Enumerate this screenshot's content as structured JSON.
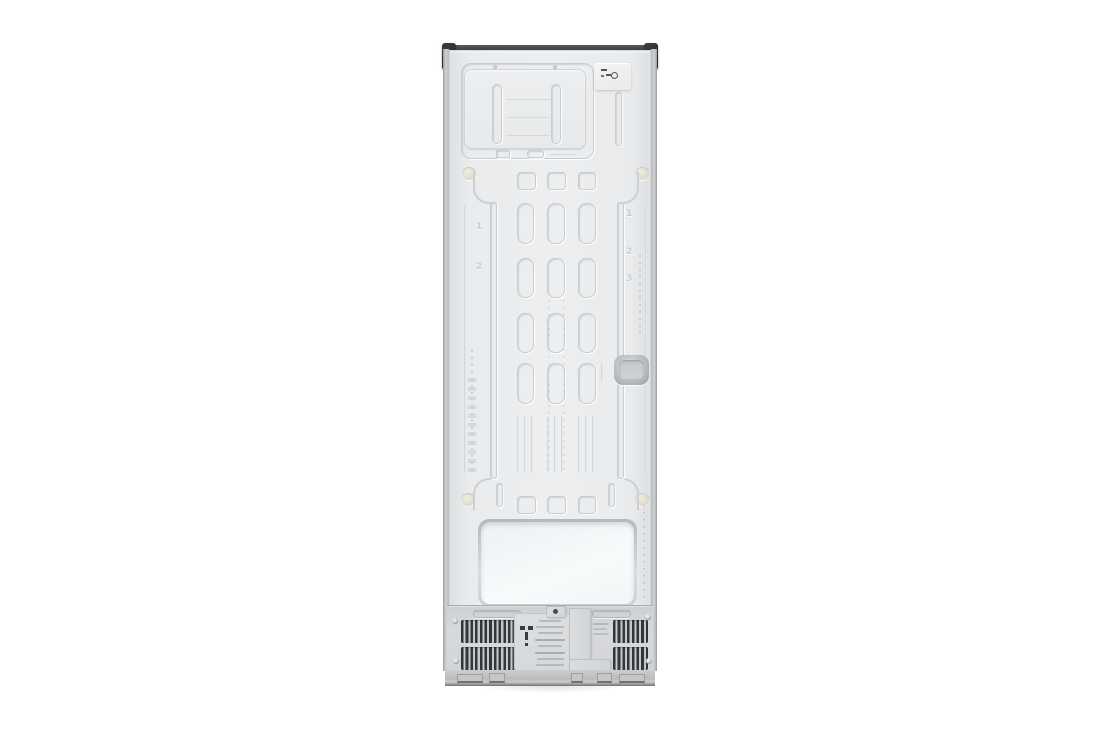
{
  "subject": {
    "type": "appliance-photo",
    "view": "refrigerator-back-panel"
  },
  "panel": {
    "left_numbers": [
      "1",
      "2"
    ],
    "right_numbers": [
      "1",
      "2",
      "3"
    ]
  },
  "icons": {
    "grounding_plug_icon": "plug-symbol",
    "screw_icon": "phillips-screw-head",
    "corner_cap_icon": "mounting-bracket"
  },
  "colors": {
    "background": "#ffffff",
    "panel": "#e9ebed",
    "panel_groove": "#c9ccce",
    "top_cap": "#2a2d30",
    "boss": "#e5e1d5",
    "vent_slat": "#33363a",
    "machine_bg": "#d4d6d8",
    "recess_cover": "#f4f7f8",
    "grip_recess": "#a2a9ad",
    "base_dark": "#6f7173"
  }
}
